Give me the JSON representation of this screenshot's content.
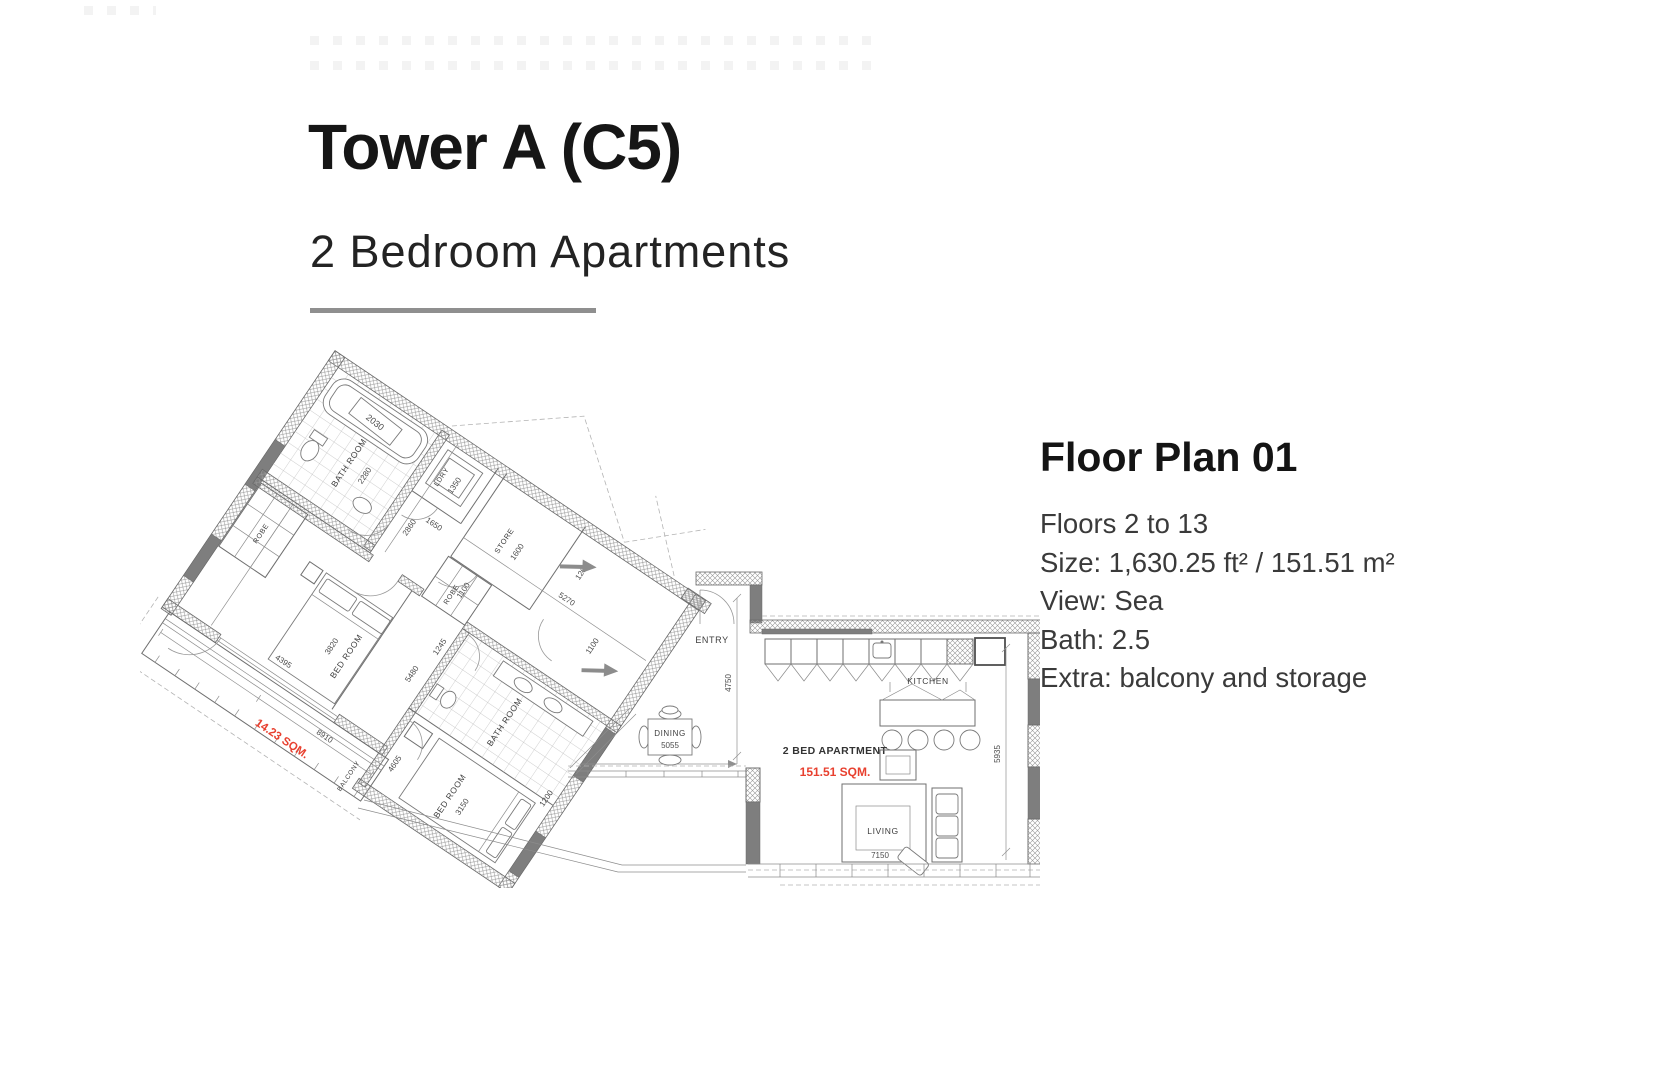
{
  "page": {
    "title": "Tower A (C5)",
    "subtitle": "2 Bedroom Apartments"
  },
  "info": {
    "heading": "Floor Plan 01",
    "lines": [
      "Floors 2 to 13",
      "Size: 1,630.25 ft² / 151.51 m²",
      "View: Sea",
      "Bath: 2.5",
      "Extra: balcony and storage"
    ]
  },
  "colors": {
    "accent_red": "#e8402f",
    "divider_gray": "#8f8f8f",
    "wall_gray": "#7e7e7e"
  },
  "floor_plan": {
    "wing": {
      "bathroom1": {
        "label": "BATH ROOM",
        "dim": "2280",
        "tub_dim": "2030"
      },
      "robe1": {
        "label": "ROBE"
      },
      "ldry": {
        "label": "LDRY",
        "dim": "1350"
      },
      "store": {
        "label": "STORE",
        "dim": "1600"
      },
      "bedroom1": {
        "label": "BED ROOM",
        "dim": "3820",
        "width_dim": "4395"
      },
      "robe2": {
        "label": "ROBE",
        "dim": "1245"
      },
      "bathroom2": {
        "label": "BATH ROOM"
      },
      "bedroom2": {
        "label": "BED ROOM",
        "dim": "3150",
        "width_dim": "4605"
      },
      "balcony": {
        "label": "BALCONY",
        "area": "14.23 SQM.",
        "length_dim": "8910"
      },
      "dims": {
        "hall_a": "2860",
        "hall_b": "1650",
        "hall_c": "1100",
        "hall_d": "5270",
        "hall_e": "1200",
        "wall_dim": "5480",
        "side_dim": "1100",
        "edge_dim": "1200"
      }
    },
    "main": {
      "entry": {
        "label": "ENTRY",
        "dim": "4750"
      },
      "kitchen": {
        "label": "KITCHEN"
      },
      "dining": {
        "label": "DINING",
        "dim": "5055"
      },
      "living": {
        "label": "LIVING",
        "dim": "7150"
      },
      "apartment_label": "2 BED APARTMENT",
      "apartment_area": "151.51 SQM.",
      "side_dim": "5935"
    }
  }
}
